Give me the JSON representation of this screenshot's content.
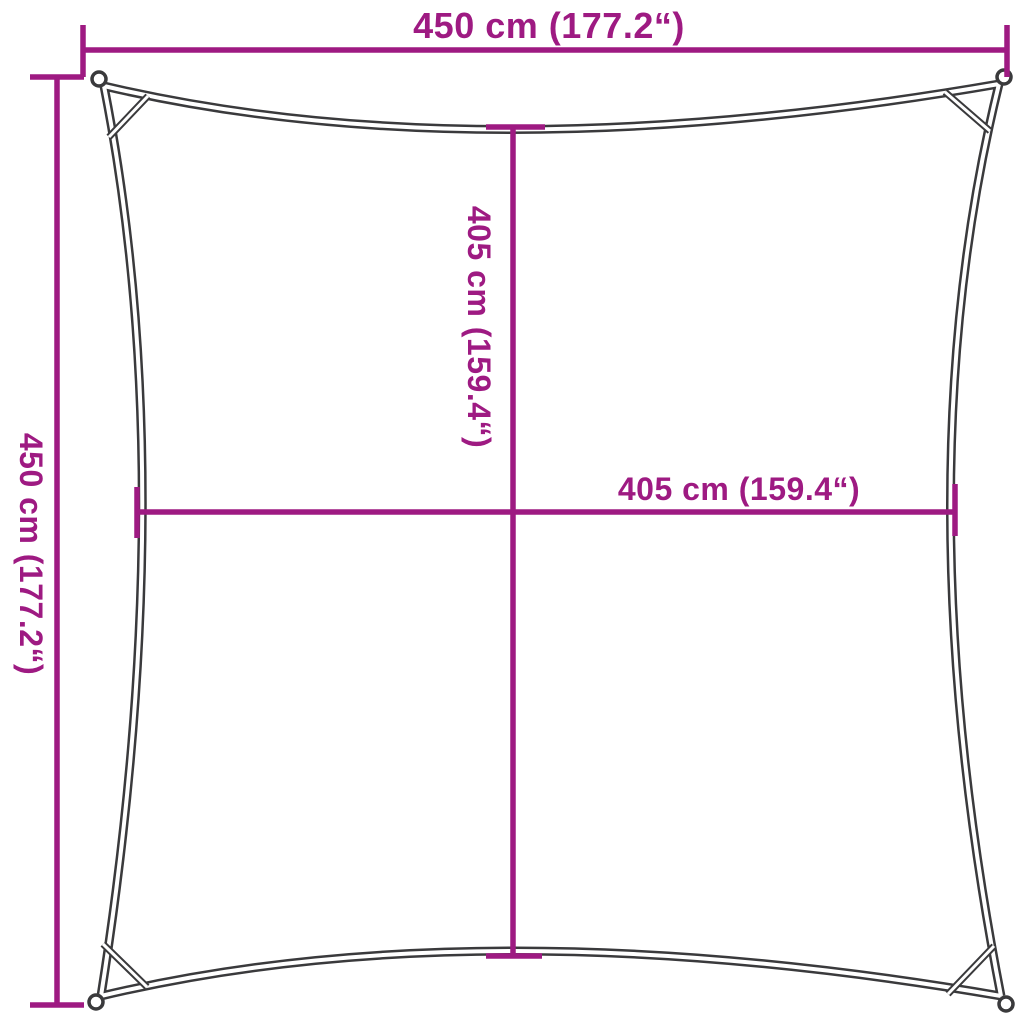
{
  "diagram": {
    "title": "square-shade-sail-dimension-diagram",
    "colors": {
      "dimension": "#9E1A82",
      "outline": "#3A3A3C",
      "background": "#FFFFFF"
    },
    "dimensions": {
      "top_width": "450 cm (177.2“)",
      "left_height": "450 cm (177.2“)",
      "inner_vertical": "405 cm (159.4“)",
      "inner_horizontal": "405 cm (159.4“)"
    }
  }
}
